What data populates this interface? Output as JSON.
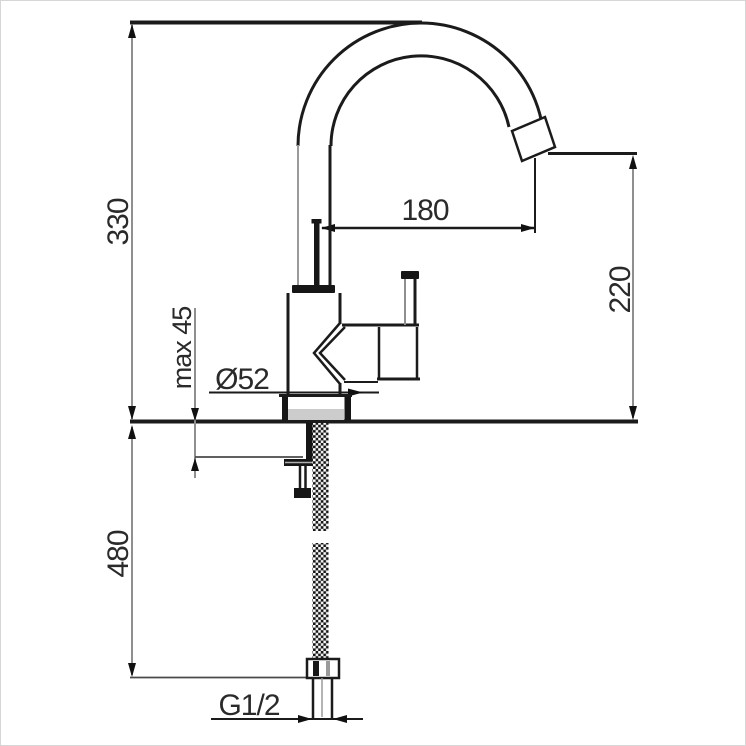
{
  "drawing": {
    "kind": "faucet-installation-dimension-drawing",
    "labels": {
      "dim_height_overall": "330",
      "dim_spout_reach": "180",
      "dim_outlet_height": "220",
      "dim_max_deck": "max 45",
      "dim_base_diameter": "Ø52",
      "dim_hose_length": "480",
      "dim_thread": "G1/2"
    },
    "colors": {
      "object_line": "#1b1b1b",
      "dimension_line": "#8f8f8f",
      "label_text": "#2a2a2a",
      "background": "#ffffff",
      "shadow_fill": "#cccccc"
    }
  }
}
